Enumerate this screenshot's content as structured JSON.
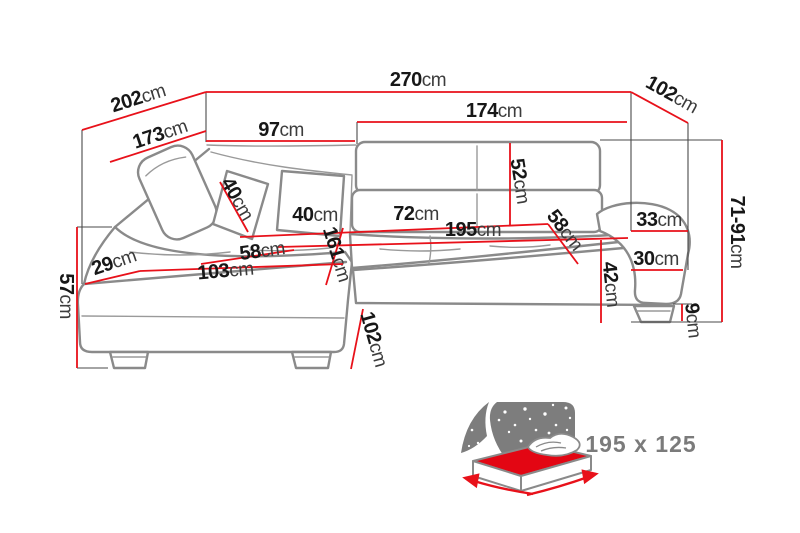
{
  "page": {
    "background": "#ffffff"
  },
  "colors": {
    "dimension_line_red": "#e8111a",
    "sofa_outline_gray": "#8a8a8a",
    "label_black": "#171717",
    "icon_text_gray": "#7b7b7b",
    "night_sky_gray": "#7d7d7d",
    "mattress_red": "#e30613"
  },
  "diagram": {
    "type": "corner-sofa-dimension-drawing",
    "unit": "cm",
    "dimensions": [
      {
        "name": "total-width",
        "value": "270",
        "unit": "cm"
      },
      {
        "name": "left-diagonal-depth",
        "value": "202",
        "unit": "cm"
      },
      {
        "name": "chaise-back-length",
        "value": "173",
        "unit": "cm"
      },
      {
        "name": "chaise-back-top",
        "value": "97",
        "unit": "cm"
      },
      {
        "name": "backrest-width",
        "value": "174",
        "unit": "cm"
      },
      {
        "name": "right-corner-diagonal",
        "value": "102",
        "unit": "cm"
      },
      {
        "name": "backrest-height",
        "value": "52",
        "unit": "cm"
      },
      {
        "name": "headrest-pillow-size",
        "value": "40",
        "unit": "cm"
      },
      {
        "name": "back-pillow-width",
        "value": "40",
        "unit": "cm"
      },
      {
        "name": "seat-segment-width",
        "value": "72",
        "unit": "cm"
      },
      {
        "name": "sleeping-length",
        "value": "195",
        "unit": "cm"
      },
      {
        "name": "seat-depth-right",
        "value": "58",
        "unit": "cm"
      },
      {
        "name": "armrest-top-width",
        "value": "33",
        "unit": "cm"
      },
      {
        "name": "adjustable-height-range",
        "value": "71-91",
        "unit": "cm"
      },
      {
        "name": "chaise-seat-width",
        "value": "58",
        "unit": "cm"
      },
      {
        "name": "chaise-seat-length",
        "value": "161",
        "unit": "cm"
      },
      {
        "name": "front-corner-width",
        "value": "29",
        "unit": "cm"
      },
      {
        "name": "chaise-front-width",
        "value": "103",
        "unit": "cm"
      },
      {
        "name": "armrest-side-height",
        "value": "30",
        "unit": "cm"
      },
      {
        "name": "seat-height",
        "value": "42",
        "unit": "cm"
      },
      {
        "name": "overall-height",
        "value": "57",
        "unit": "cm"
      },
      {
        "name": "leg-height",
        "value": "9",
        "unit": "cm"
      },
      {
        "name": "chaise-depth",
        "value": "102",
        "unit": "cm"
      }
    ],
    "sleeping_area": {
      "label": "195 x 125"
    }
  }
}
